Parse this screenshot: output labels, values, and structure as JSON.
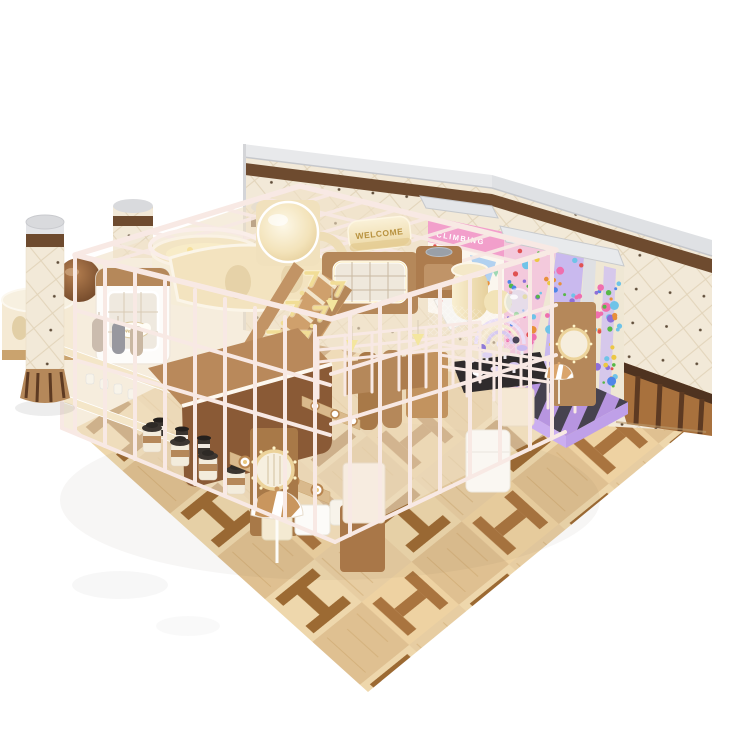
{
  "scene": {
    "description": "3D render of a chocolate and cream themed indoor soft-play playground with candy climbing wall, glowing staircase, parquet floor, quilted cream walls and wrapped columns",
    "background": "#ffffff"
  },
  "texts": {
    "welcome_main": "WELCOME",
    "welcome_cloud": "Welcome",
    "climbing_sign": "CLIMBING"
  },
  "palette": {
    "frame_white": "#f8e9e4",
    "cream_panel": "#f2e2bd",
    "wood_brown": "#b5885a",
    "wood_brown_dark": "#a87948",
    "chocolate": "#8a5a36",
    "wall_cream": "#f2e9d8",
    "wall_stripe_brown": "#6e4b2f",
    "silver_trim": "#e6e7ea",
    "floor_light": "#e7cda2",
    "floor_motif": "#9c6a33",
    "glow_yellow": "#f1dd96",
    "mat_purple": "#b795e0",
    "mat_stripe": "#46424f",
    "sign_pink": "#f29fcb",
    "lavender": "#c9b9ee",
    "gold": "#b8923f"
  },
  "climbing_wall": {
    "hold_colors": [
      "#e05252",
      "#4f86e8",
      "#57b847",
      "#e8903a",
      "#ecc844",
      "#ef6fae",
      "#6fc3e8",
      "#8e6fd8"
    ],
    "zones": [
      {
        "quad": [
          [
            507,
            246
          ],
          [
            584,
            260
          ],
          [
            576,
            404
          ],
          [
            507,
            392
          ]
        ],
        "count": 85
      },
      {
        "quad": [
          [
            597,
            264
          ],
          [
            622,
            270
          ],
          [
            616,
            412
          ],
          [
            591,
            406
          ]
        ],
        "count": 40
      },
      {
        "quad": [
          [
            433,
            244
          ],
          [
            501,
            260
          ],
          [
            501,
            316
          ],
          [
            433,
            300
          ]
        ],
        "count": 14
      }
    ]
  },
  "floor": {
    "light": "#e7cda2",
    "tint_a": "#eed7ac",
    "tint_b": "#dfc091",
    "motif": "#9c6a33",
    "grain": "#c9a268"
  },
  "mat": {
    "base": "#b795e0",
    "stripe": "#46424f"
  },
  "stairs": {
    "glow": "#f1dd96",
    "arrow_count": 11
  }
}
